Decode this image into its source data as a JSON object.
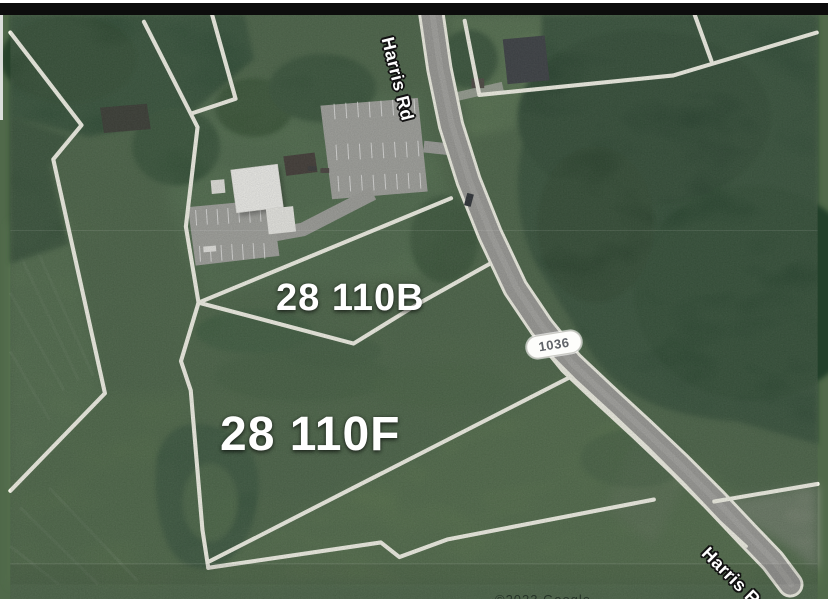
{
  "map": {
    "labels": {
      "road_top": "Harris Rd",
      "road_bottom": "Harris Rd",
      "route_marker": "1036",
      "parcel_b": "28 110B",
      "parcel_f": "28 110F"
    },
    "attribution": "©2023 Google",
    "colors": {
      "parcel_line": "#f8f8ec",
      "road_fill": "#9c9c98",
      "forest_green": "#2a4630",
      "field_green": "#50694a",
      "label_text": "#ffffff",
      "route_badge_bg": "#fdfdfb",
      "route_badge_text": "#5f6368",
      "top_bar": "#0c0c0c"
    }
  }
}
